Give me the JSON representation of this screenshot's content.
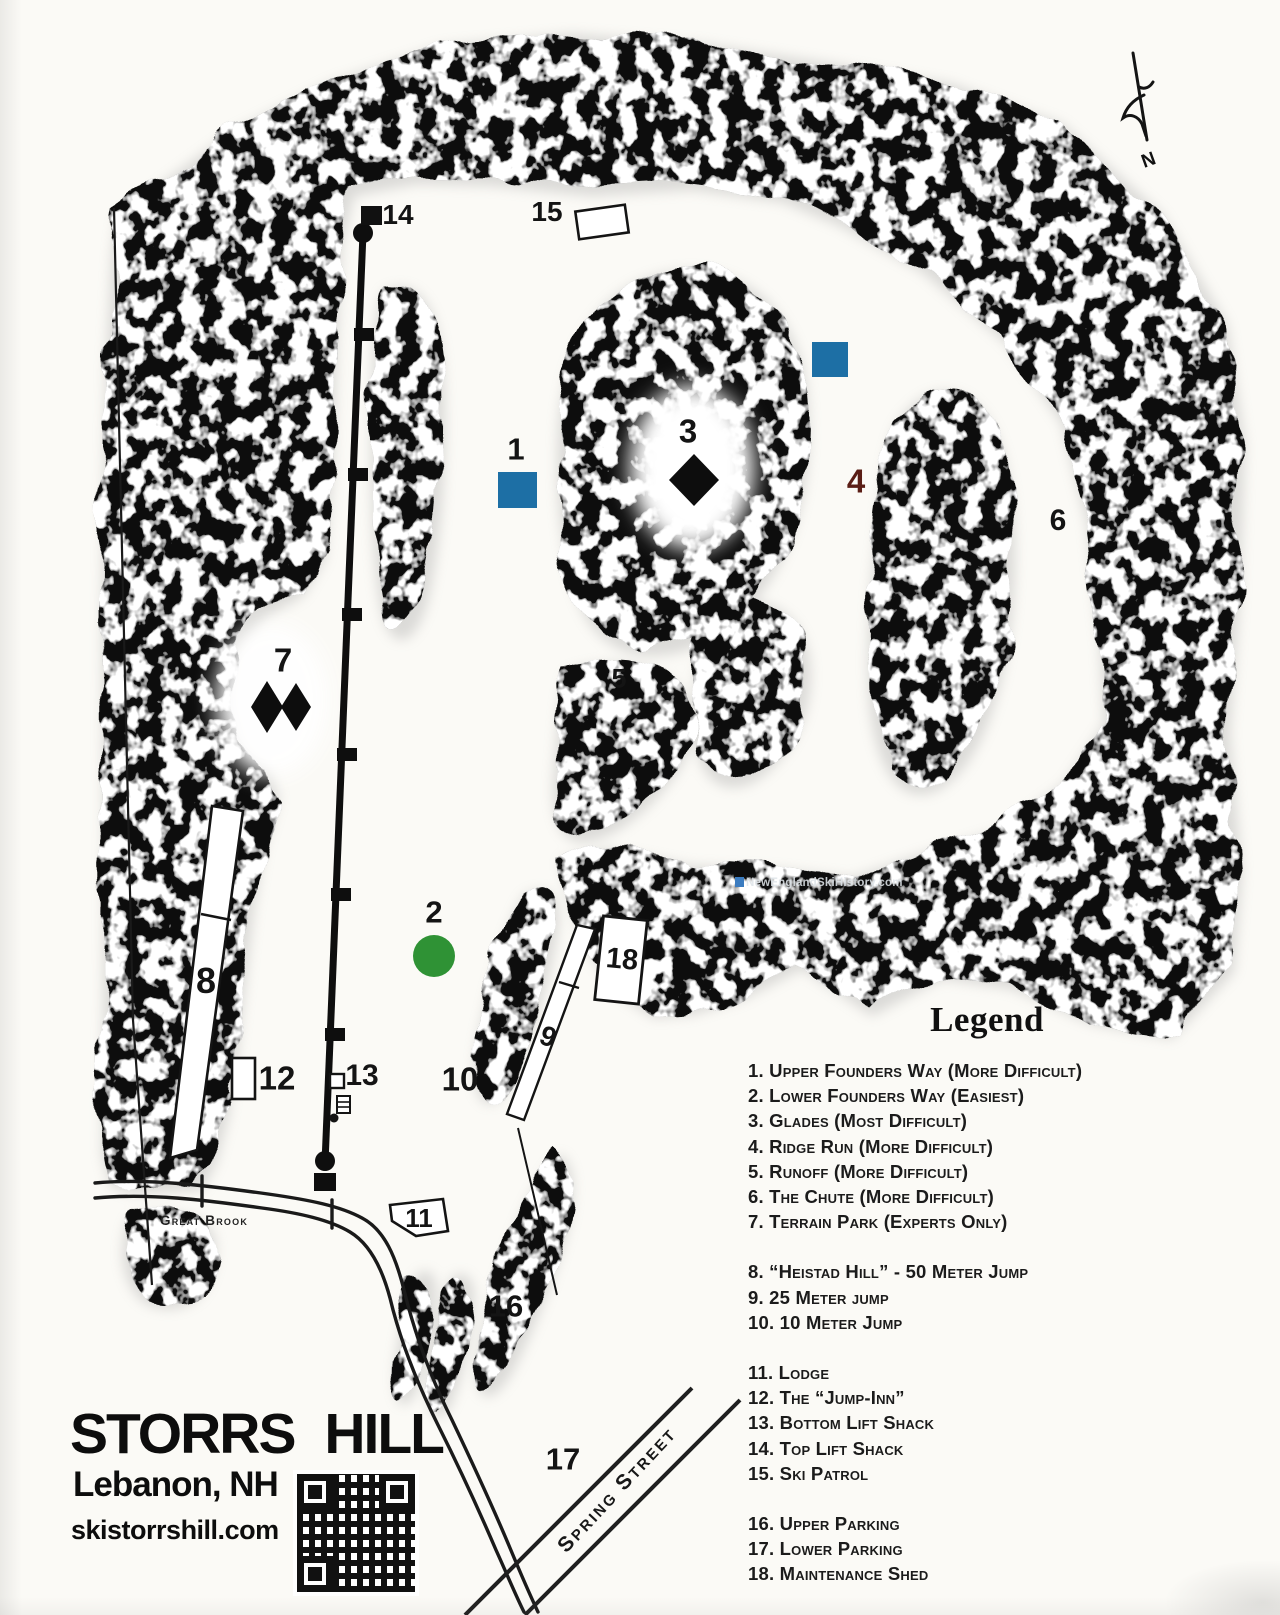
{
  "page": {
    "width": 1280,
    "height": 1615
  },
  "map": {
    "resort_title": "STORRS HILL",
    "location": "Lebanon, NH",
    "website": "skistorrshill.com",
    "compass_label": "N",
    "watermark": "NewEnglandSkiHistory.com",
    "labels": {
      "brook": "Great Brook",
      "street": "Spring Street"
    },
    "markers": {
      "m1": "1",
      "m2": "2",
      "m3": "3",
      "m4": "4",
      "m5": "5",
      "m6": "6",
      "m7": "7",
      "m8": "8",
      "m9": "9",
      "m10": "10",
      "m11": "11",
      "m12": "12",
      "m13": "13",
      "m14": "14",
      "m15": "15",
      "m16": "16",
      "m17": "17",
      "m18": "18"
    },
    "symbol_colors": {
      "easiest_green": "#2f9235",
      "more_difficult_blue": "#1d6fa5",
      "most_difficult_black": "#111111",
      "ridge_run_number_maroon": "#5a1d15"
    }
  },
  "legend": {
    "title": "Legend",
    "groups": [
      {
        "items": [
          "1. Upper Founders Way (More Difficult)",
          "2. Lower Founders Way (Easiest)",
          "3. Glades (Most Difficult)",
          "4. Ridge Run (More Difficult)",
          "5. Runoff (More Difficult)",
          "6. The Chute (More Difficult)",
          "7. Terrain Park (Experts Only)"
        ]
      },
      {
        "items": [
          "8. “Heistad Hill” - 50 Meter Jump",
          "9. 25 Meter jump",
          "10. 10 Meter Jump"
        ]
      },
      {
        "items": [
          "11. Lodge",
          "12. The “Jump-Inn”",
          "13. Bottom Lift Shack",
          "14. Top Lift Shack",
          "15. Ski Patrol"
        ]
      },
      {
        "items": [
          "16. Upper Parking",
          "17. Lower Parking",
          "18. Maintenance Shed"
        ]
      }
    ]
  }
}
